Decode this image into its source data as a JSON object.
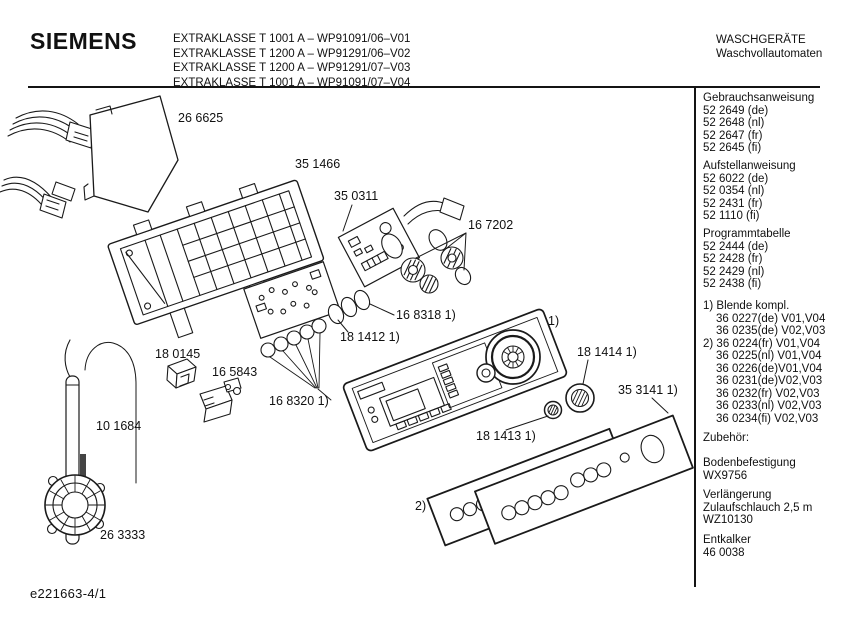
{
  "header": {
    "brand": "SIEMENS",
    "models": [
      "EXTRAKLASSE T 1001 A – WP91091/06–V01",
      "EXTRAKLASSE T 1200 A – WP91291/06–V02",
      "EXTRAKLASSE T 1200 A – WP91291/07–V03",
      "EXTRAKLASSE T 1001 A – WP91091/07–V04"
    ],
    "category": "WASCHGERÄTE",
    "category_sub": "Waschvollautomaten"
  },
  "sidebar": {
    "sections": [
      {
        "title": "Gebrauchsanweisung",
        "items": [
          "52 2649 (de)",
          "52 2648 (nl)",
          "52 2647 (fr)",
          "52 2645 (fi)"
        ]
      },
      {
        "title": "Aufstellanweisung",
        "items": [
          "52 6022 (de)",
          "52 0354 (nl)",
          "52 2431 (fr)",
          "52 1110 (fi)"
        ]
      },
      {
        "title": "Programmtabelle",
        "items": [
          "52 2444 (de)",
          "52 2428 (fr)",
          "52 2429 (nl)",
          "52 2438 (fi)"
        ]
      }
    ],
    "blende_lines": [
      "1) Blende kompl.",
      "36 0227(de) V01,V04",
      "36 0235(de) V02,V03",
      "2) 36 0224(fr) V01,V04",
      "36 0225(nl) V01,V04",
      "36 0226(de)V01,V04",
      "36 0231(de)V02,V03",
      "36 0232(fr) V02,V03",
      "36 0233(nl) V02,V03",
      "36 0234(fi) V02,V03"
    ],
    "accessories": {
      "title": "Zubehör:",
      "entries": [
        {
          "lines": [
            "Bodenbefestigung",
            "WX9756"
          ]
        },
        {
          "lines": [
            "Verlängerung",
            "Zulaufschlauch 2,5 m",
            "WZ10130"
          ]
        },
        {
          "lines": [
            "Entkalker",
            "46 0038"
          ]
        }
      ]
    }
  },
  "diagram": {
    "labels": [
      {
        "text": "26 6625"
      },
      {
        "text": "35 1466"
      },
      {
        "text": "35 0311"
      },
      {
        "text": "16 7202"
      },
      {
        "text": "16 8318 1)"
      },
      {
        "text": "18 1412 1)"
      },
      {
        "text": "18 0145"
      },
      {
        "text": "16 5843"
      },
      {
        "text": "16 8320 1)"
      },
      {
        "text": "10 1684"
      },
      {
        "text": "26 3333"
      },
      {
        "text": "18 1413 1)"
      },
      {
        "text": "18 1414 1)"
      },
      {
        "text": "35 3141 1)"
      },
      {
        "text": "1)"
      },
      {
        "text": "2)"
      }
    ]
  },
  "footer": {
    "doc_number": "e221663-4/1"
  }
}
